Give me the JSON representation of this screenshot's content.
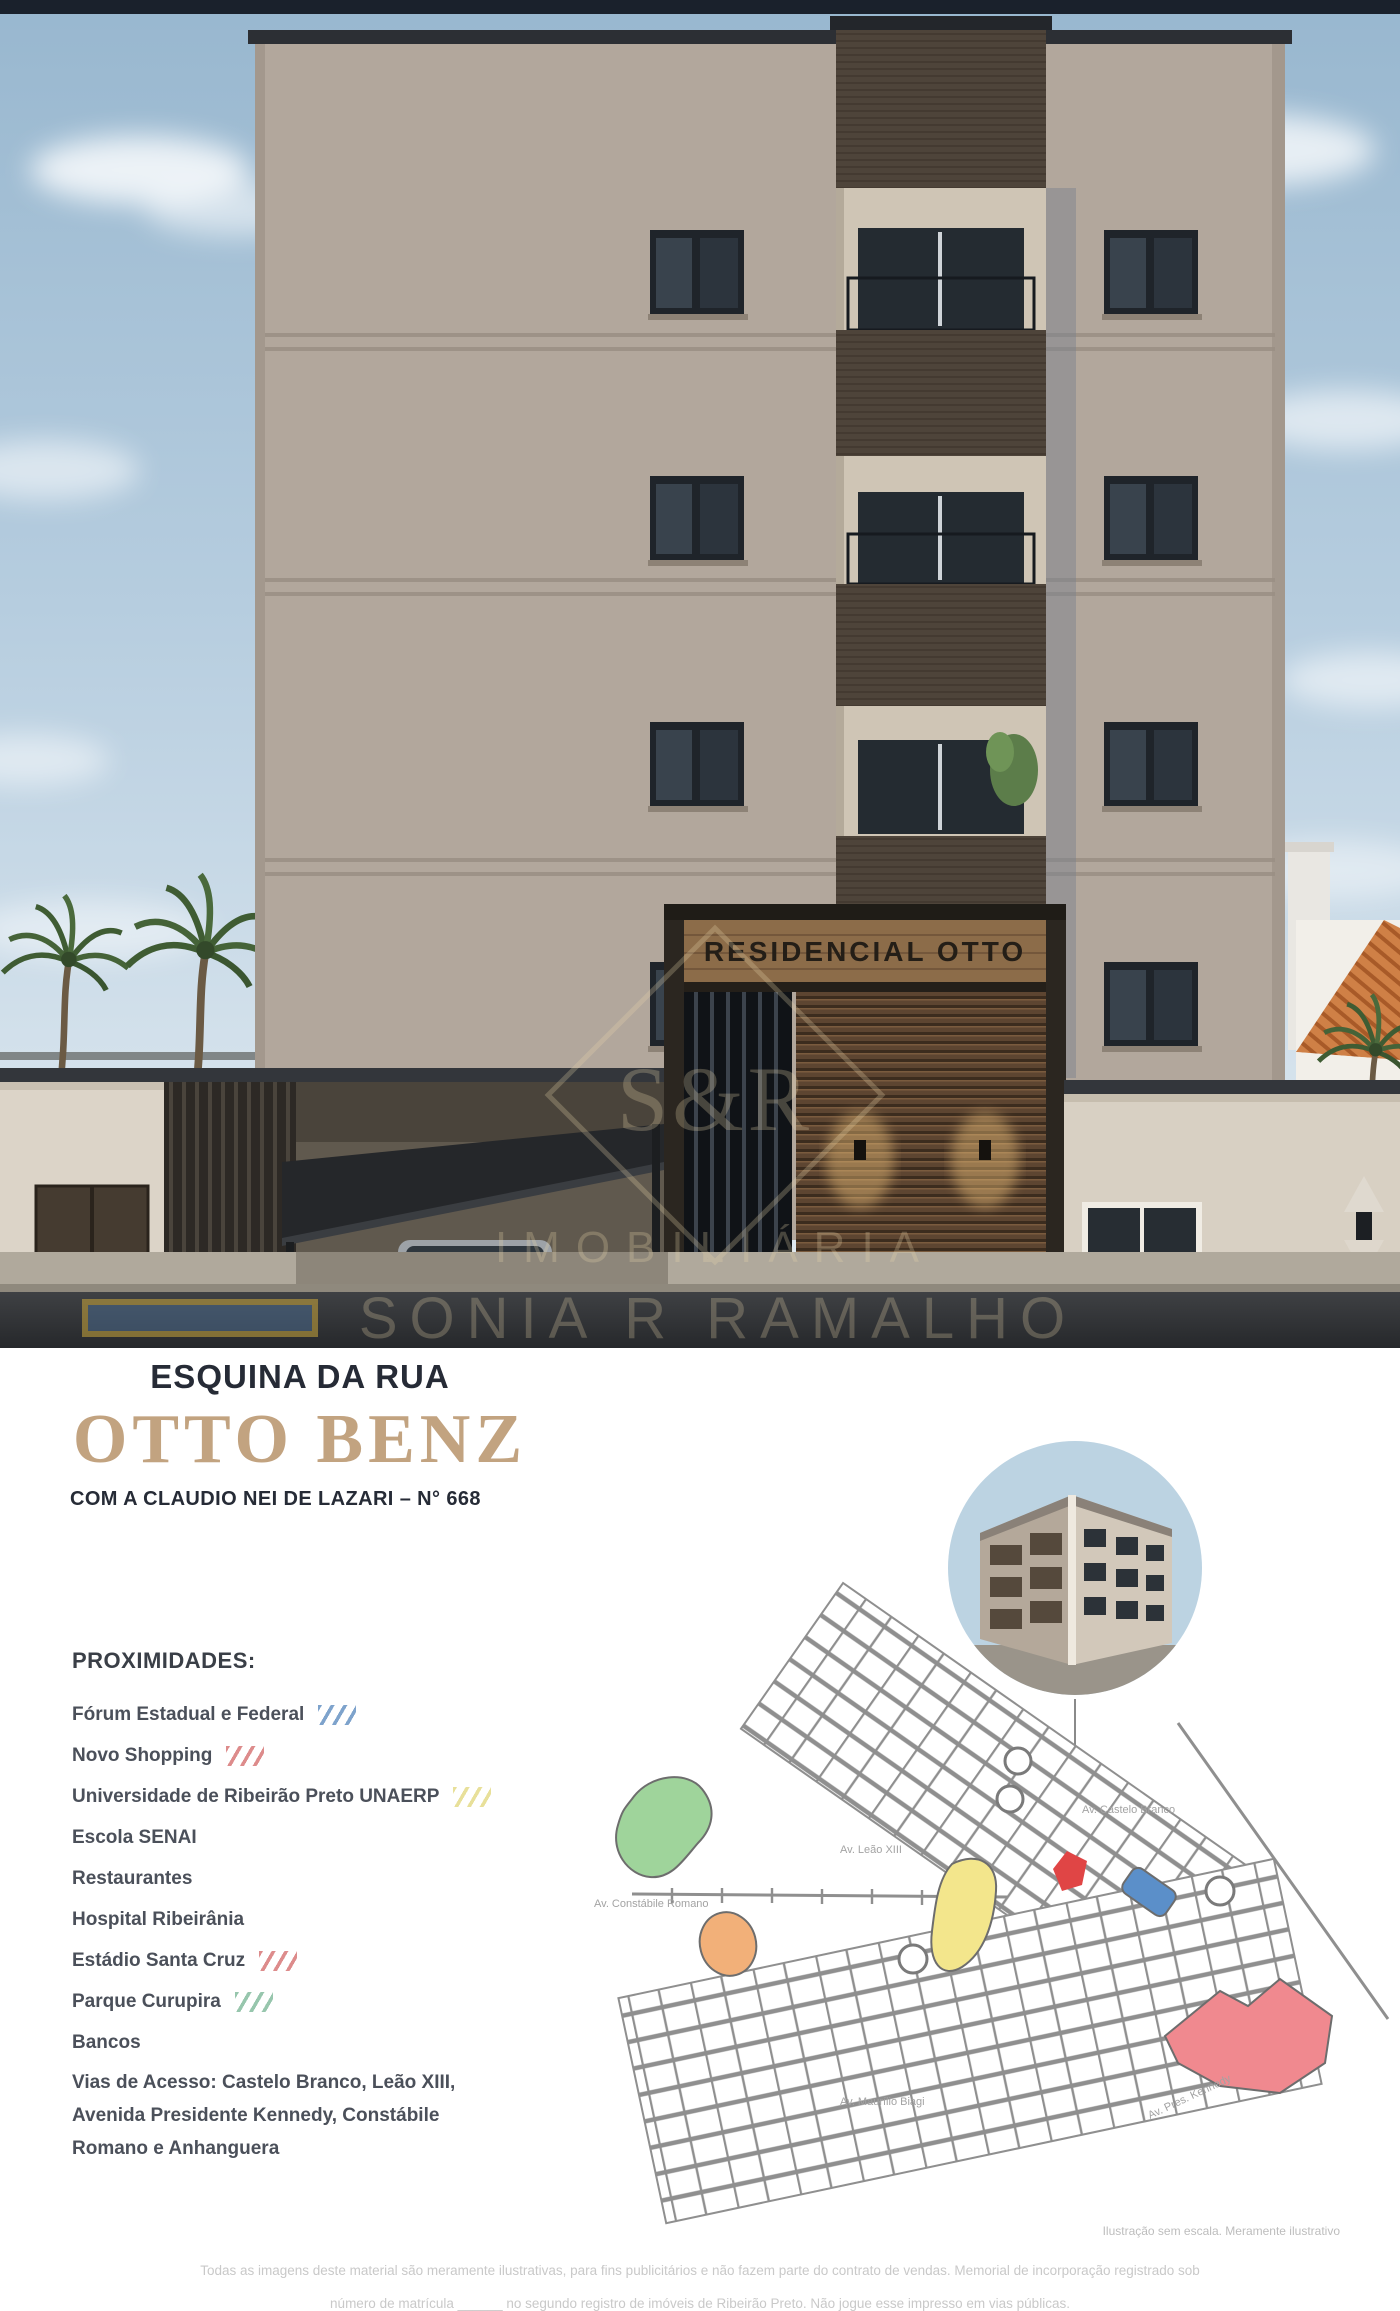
{
  "building_render": {
    "sign_text": "RESIDENCIAL OTTO",
    "watermark": {
      "monogram": "S&R",
      "line1": "IMOBILIÁRIA",
      "line2": "SONIA R RAMALHO"
    },
    "colors": {
      "facade": "#b2a79c",
      "balcony_dark": "#4e443a",
      "sky_top": "#98b7cf",
      "roof_tiles": "#c9793f"
    }
  },
  "flyer": {
    "headline_top": "ESQUINA DA RUA",
    "headline_main": "OTTO BENZ",
    "headline_sub": "COM A CLAUDIO NEI DE LAZARI – N° 668",
    "accent_color": "#c2a380"
  },
  "proximities": {
    "title": "PROXIMIDADES:",
    "items": [
      {
        "label": "Fórum Estadual e Federal",
        "slash_color": "#7ea3cc"
      },
      {
        "label": "Novo Shopping",
        "slash_color": "#dd8c8c"
      },
      {
        "label": "Universidade de Ribeirão Preto  UNAERP",
        "slash_color": "#e8e09a"
      },
      {
        "label": "Escola SENAI",
        "slash_color": null
      },
      {
        "label": "Restaurantes",
        "slash_color": null
      },
      {
        "label": "Hospital Ribeirânia",
        "slash_color": null
      },
      {
        "label": "Estádio Santa Cruz",
        "slash_color": "#dd8c8c"
      },
      {
        "label": "Parque Curupira",
        "slash_color": "#97c6ad"
      },
      {
        "label": "Bancos",
        "slash_color": null
      },
      {
        "label": "Vias de Acesso: Castelo Branco, Leão XIII,\nAvenida Presidente Kennedy, Constábile\nRomano e Anhanguera",
        "slash_color": null
      }
    ]
  },
  "map": {
    "labels": [
      "Av. Castelo Branco",
      "Av. Leão XIII",
      "Av. Constábile Romano",
      "Av. Maurílio Biagi",
      "Av. Pres. Kennedy"
    ]
  },
  "footnotes": {
    "map_note": "Ilustração sem escala. Meramente ilustrativo",
    "disclaimer_line1": "Todas as imagens deste material são meramente ilustrativas, para fins publicitários e não fazem parte do contrato de vendas. Memorial de incorporação registrado sob",
    "disclaimer_line2": "número de matrícula ______ no segundo registro de imóveis de Ribeirão Preto. Não jogue esse impresso em vias públicas."
  }
}
